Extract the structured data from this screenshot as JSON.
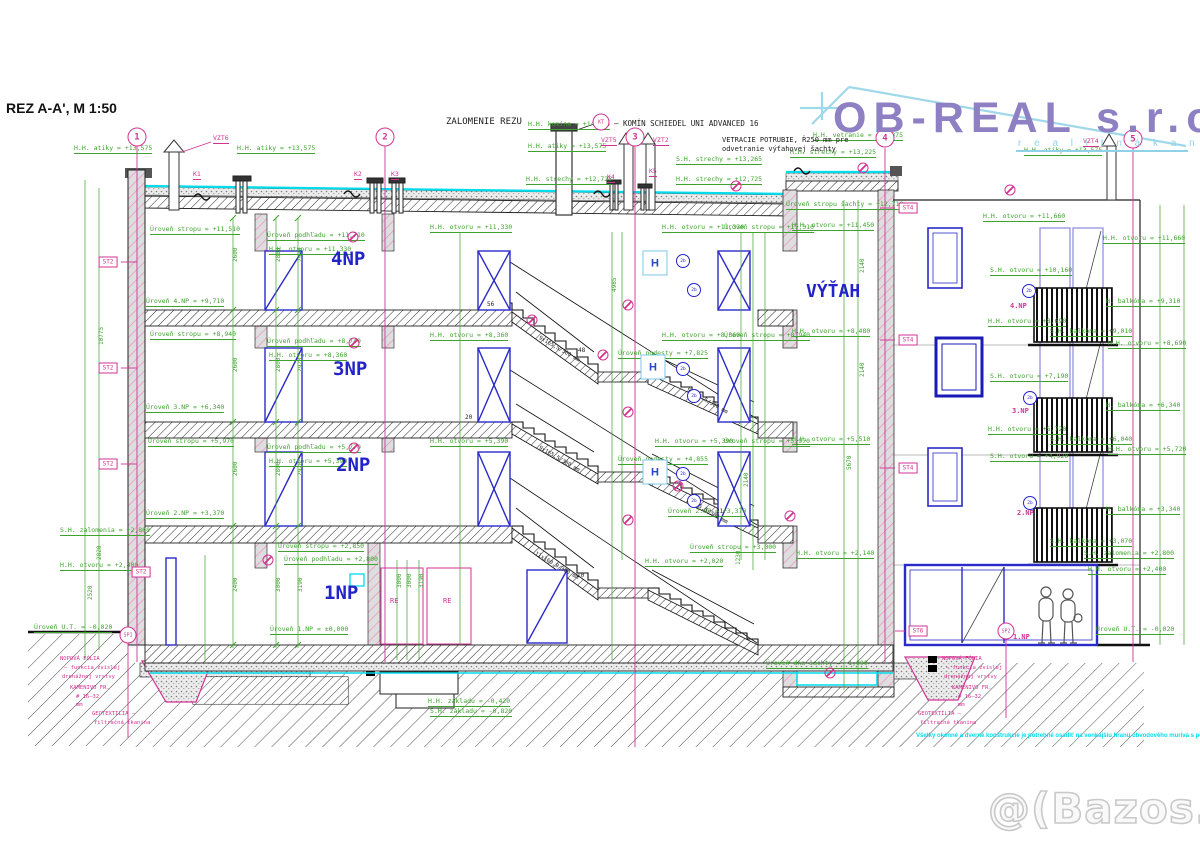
{
  "title": {
    "text": "REZ A-A', M 1:50"
  },
  "logo": {
    "brand": "OB-REAL s.r.o.",
    "tagline": "r e a l i t n á   k a n c e l á r i a"
  },
  "watermark": {
    "text": "@(Bazos.sk"
  },
  "note": {
    "text": "Všetky okenné a dverné konštrukcie je potrebné osadiť na vonkajšiu hranu obvodového muriva s použitím kotiev"
  },
  "h_label": "H",
  "colors": {
    "dim_green": "#3da32c",
    "marker_magenta": "#d23393",
    "element_blue": "#2323cc",
    "waterproof_cyan": "#00dcec",
    "logo_purple": "#8f80c4",
    "logo_lightblue": "#8fd2e8"
  },
  "axis_markers": [
    {
      "n": "1",
      "x": 137,
      "y": 137
    },
    {
      "n": "2",
      "x": 385,
      "y": 137
    },
    {
      "n": "3",
      "x": 635,
      "y": 137
    },
    {
      "n": "4",
      "x": 885,
      "y": 138
    },
    {
      "n": "5",
      "x": 1133,
      "y": 139
    }
  ],
  "boxed_labels": [
    {
      "t": "ST2",
      "x": 108,
      "y": 262
    },
    {
      "t": "ST2",
      "x": 108,
      "y": 368
    },
    {
      "t": "ST2",
      "x": 108,
      "y": 464
    },
    {
      "t": "ST2",
      "x": 141,
      "y": 572
    },
    {
      "t": "ST4",
      "x": 908,
      "y": 208
    },
    {
      "t": "ST4",
      "x": 908,
      "y": 340
    },
    {
      "t": "ST4",
      "x": 908,
      "y": 468
    },
    {
      "t": "ST6",
      "x": 918,
      "y": 631
    }
  ],
  "circle_labels": [
    {
      "t": "KT",
      "x": 601,
      "y": 122
    },
    {
      "t": "SP1",
      "x": 128,
      "y": 635
    },
    {
      "t": "SP2",
      "x": 1006,
      "y": 631
    }
  ],
  "small_circles": [
    {
      "t": "2b",
      "x": 683,
      "y": 261
    },
    {
      "t": "2b",
      "x": 694,
      "y": 290
    },
    {
      "t": "2b",
      "x": 683,
      "y": 369
    },
    {
      "t": "2b",
      "x": 694,
      "y": 396
    },
    {
      "t": "2b",
      "x": 683,
      "y": 474
    },
    {
      "t": "2b",
      "x": 694,
      "y": 501
    },
    {
      "t": "2b",
      "x": 1029,
      "y": 291
    },
    {
      "t": "2b",
      "x": 1030,
      "y": 398
    },
    {
      "t": "2b",
      "x": 1030,
      "y": 503
    }
  ],
  "h_boxes": [
    {
      "x": 655,
      "y": 263
    },
    {
      "x": 653,
      "y": 367
    },
    {
      "x": 655,
      "y": 472
    }
  ],
  "detail_circles": [
    {
      "x": 353,
      "y": 237
    },
    {
      "x": 354,
      "y": 343
    },
    {
      "x": 354,
      "y": 448
    },
    {
      "x": 268,
      "y": 560
    },
    {
      "x": 532,
      "y": 320
    },
    {
      "x": 603,
      "y": 355
    },
    {
      "x": 678,
      "y": 486
    },
    {
      "x": 790,
      "y": 516
    },
    {
      "x": 830,
      "y": 673
    },
    {
      "x": 1010,
      "y": 190
    },
    {
      "x": 628,
      "y": 305
    },
    {
      "x": 628,
      "y": 412
    },
    {
      "x": 628,
      "y": 520
    },
    {
      "x": 736,
      "y": 186
    },
    {
      "x": 863,
      "y": 168
    }
  ],
  "labels": [
    {
      "t": "H.H. atiky = +13,575",
      "x": 74,
      "y": 145
    },
    {
      "t": "H.H. atiky = +13,575",
      "x": 237,
      "y": 145
    },
    {
      "t": "H.H. komína = +14,225",
      "x": 528,
      "y": 121
    },
    {
      "t": "H.H. atiky = +13,575",
      "x": 528,
      "y": 143
    },
    {
      "t": "S.H. strechy = +13,265",
      "x": 676,
      "y": 156
    },
    {
      "t": "H.H. strechy = +12,725",
      "x": 526,
      "y": 176
    },
    {
      "t": "H.H. strechy = +12,725",
      "x": 676,
      "y": 176
    },
    {
      "t": "H.H. atiky = +13,575",
      "x": 1024,
      "y": 147
    },
    {
      "t": "H.H. vetranie = +13,875",
      "x": 813,
      "y": 132
    },
    {
      "t": "H.H. strechy = +13,225",
      "x": 790,
      "y": 149
    },
    {
      "t": "Úroveň stropu šachty = +12,710",
      "x": 786,
      "y": 201
    },
    {
      "t": "H.H. otvoru = +11,450",
      "x": 792,
      "y": 222
    },
    {
      "t": "Úroveň stropu = +11,510",
      "x": 150,
      "y": 226
    },
    {
      "t": "Úroveň podhľadu = +11,710",
      "x": 267,
      "y": 232
    },
    {
      "t": "H.H. otvoru = +11,330",
      "x": 269,
      "y": 246
    },
    {
      "t": "H.H. otvoru = +11,330",
      "x": 430,
      "y": 224
    },
    {
      "t": "H.H. otvoru = +11,330",
      "x": 662,
      "y": 224
    },
    {
      "t": "Úroveň stropu = +11,310",
      "x": 724,
      "y": 224
    },
    {
      "t": "Úroveň 4.NP = +9,710",
      "x": 146,
      "y": 298
    },
    {
      "t": "Úroveň stropu = +8,940",
      "x": 150,
      "y": 331
    },
    {
      "t": "Úroveň podhľadu = +8,740",
      "x": 267,
      "y": 338
    },
    {
      "t": "H.H. otvoru = +8,360",
      "x": 269,
      "y": 352
    },
    {
      "t": "H.H. otvoru = +8,360",
      "x": 430,
      "y": 332
    },
    {
      "t": "H.H. otvoru = +8,360",
      "x": 662,
      "y": 332
    },
    {
      "t": "Úroveň stropu = +8,940",
      "x": 724,
      "y": 332
    },
    {
      "t": "Úroveň podesty = +7,825",
      "x": 618,
      "y": 350
    },
    {
      "t": "Úroveň 3.NP = +6,340",
      "x": 146,
      "y": 404
    },
    {
      "t": "Úroveň stropu = +5,970",
      "x": 148,
      "y": 438
    },
    {
      "t": "Úroveň podhľadu = +5,770",
      "x": 267,
      "y": 444
    },
    {
      "t": "H.H. otvoru = +5,390",
      "x": 269,
      "y": 458
    },
    {
      "t": "H.H. otvoru = +5,390",
      "x": 430,
      "y": 438
    },
    {
      "t": "H.H. otvoru = +5,390",
      "x": 655,
      "y": 438
    },
    {
      "t": "Úroveň stropu = +5,970",
      "x": 724,
      "y": 438
    },
    {
      "t": "Úroveň podesty = +4,855",
      "x": 618,
      "y": 456
    },
    {
      "t": "Úroveň 2.NP = +3,370",
      "x": 146,
      "y": 510
    },
    {
      "t": "Úroveň 2.NP = +3,370",
      "x": 668,
      "y": 508
    },
    {
      "t": "Úroveň stropu = +3,000",
      "x": 690,
      "y": 544
    },
    {
      "t": "Úroveň stropu = +2,850",
      "x": 278,
      "y": 543
    },
    {
      "t": "Úroveň podhľadu = +2,800",
      "x": 284,
      "y": 556
    },
    {
      "t": "S.H. zalomenia = +2,800",
      "x": 60,
      "y": 527
    },
    {
      "t": "H.H. otvoru = +2,400",
      "x": 60,
      "y": 562
    },
    {
      "t": "Úroveň U.T. = -0,020",
      "x": 34,
      "y": 624
    },
    {
      "t": "Úroveň 1.NP = ±0,000",
      "x": 270,
      "y": 626
    },
    {
      "t": "H.H. otvoru = +8,480",
      "x": 792,
      "y": 328
    },
    {
      "t": "H.H. otvoru = +5,510",
      "x": 792,
      "y": 436
    },
    {
      "t": "H.H. otvoru = +2,140",
      "x": 796,
      "y": 550
    },
    {
      "t": "H.H. otvoru = +2,020",
      "x": 645,
      "y": 558
    },
    {
      "t": "Úroveň dna šachty = -1,000",
      "x": 766,
      "y": 660
    },
    {
      "t": "H.H. základu = -0,420",
      "x": 428,
      "y": 698
    },
    {
      "t": "S.H. základu = -0,820",
      "x": 430,
      "y": 708
    },
    {
      "t": "S.H. zalomenia = +2,800",
      "x": 1084,
      "y": 550
    },
    {
      "t": "H.H. otvoru = +2,400",
      "x": 1088,
      "y": 566
    },
    {
      "t": "Úroveň U.T. = -0,020",
      "x": 1096,
      "y": 626
    },
    {
      "t": "H.H. otvoru = +11,660",
      "x": 983,
      "y": 213
    },
    {
      "t": "H.H. otvoru = +11,660",
      "x": 1103,
      "y": 235
    },
    {
      "t": "S.H. otvoru = +10,160",
      "x": 990,
      "y": 267
    },
    {
      "t": "H. balkóna = +9,310",
      "x": 1106,
      "y": 298
    },
    {
      "t": "H.H. otvoru = +8,690",
      "x": 988,
      "y": 318
    },
    {
      "t": "S.H. balkóna = +9,010",
      "x": 1050,
      "y": 328
    },
    {
      "t": "H.H. otvoru = +8,690",
      "x": 1108,
      "y": 340
    },
    {
      "t": "S.H. otvoru = +7,190",
      "x": 990,
      "y": 373
    },
    {
      "t": "H. balkóna = +6,340",
      "x": 1106,
      "y": 402
    },
    {
      "t": "H.H. otvoru = +5,720",
      "x": 988,
      "y": 426
    },
    {
      "t": "S.H. balkóna = +6,040",
      "x": 1050,
      "y": 436
    },
    {
      "t": "H.H. otvoru = +5,720",
      "x": 1108,
      "y": 446
    },
    {
      "t": "S.H. otvoru = +4,920",
      "x": 990,
      "y": 453
    },
    {
      "t": "H. balkóna = +3,340",
      "x": 1106,
      "y": 506
    },
    {
      "t": "S.H. balkóna = +3,070",
      "x": 1050,
      "y": 538
    },
    {
      "t": "10775",
      "x": 99,
      "y": 345,
      "r": -90,
      "s": 6
    },
    {
      "t": "2820",
      "x": 97,
      "y": 560,
      "r": -90,
      "s": 6
    },
    {
      "t": "2520",
      "x": 88,
      "y": 600,
      "r": -90,
      "s": 6
    },
    {
      "t": "2600",
      "x": 233,
      "y": 262,
      "r": -90,
      "s": 6
    },
    {
      "t": "2800",
      "x": 276,
      "y": 262,
      "r": -90,
      "s": 6
    },
    {
      "t": "2920",
      "x": 298,
      "y": 262,
      "r": -90,
      "s": 6
    },
    {
      "t": "2600",
      "x": 233,
      "y": 372,
      "r": -90,
      "s": 6
    },
    {
      "t": "2800",
      "x": 276,
      "y": 372,
      "r": -90,
      "s": 6
    },
    {
      "t": "2920",
      "x": 298,
      "y": 372,
      "r": -90,
      "s": 6
    },
    {
      "t": "2600",
      "x": 233,
      "y": 476,
      "r": -90,
      "s": 6
    },
    {
      "t": "2800",
      "x": 276,
      "y": 476,
      "r": -90,
      "s": 6
    },
    {
      "t": "2920",
      "x": 298,
      "y": 476,
      "r": -90,
      "s": 6
    },
    {
      "t": "2400",
      "x": 233,
      "y": 592,
      "r": -90,
      "s": 6
    },
    {
      "t": "3000",
      "x": 276,
      "y": 592,
      "r": -90,
      "s": 6
    },
    {
      "t": "3190",
      "x": 298,
      "y": 592,
      "r": -90,
      "s": 6
    },
    {
      "t": "4985",
      "x": 612,
      "y": 292,
      "r": -90,
      "s": 6
    },
    {
      "t": "3000",
      "x": 397,
      "y": 588,
      "r": -90,
      "s": 6
    },
    {
      "t": "3000",
      "x": 407,
      "y": 588,
      "r": -90,
      "s": 6
    },
    {
      "t": "3190",
      "x": 419,
      "y": 588,
      "r": -90,
      "s": 6
    },
    {
      "t": "2140",
      "x": 744,
      "y": 487,
      "r": -90,
      "s": 6
    },
    {
      "t": "1230",
      "x": 736,
      "y": 565,
      "r": -90,
      "s": 6
    },
    {
      "t": "5670",
      "x": 847,
      "y": 470,
      "r": -90,
      "s": 6
    },
    {
      "t": "2140",
      "x": 860,
      "y": 273,
      "r": -90,
      "s": 6
    },
    {
      "t": "2140",
      "x": 860,
      "y": 377,
      "r": -90,
      "s": 6
    },
    {
      "t": "VZT6",
      "x": 213,
      "y": 135,
      "c": "m",
      "u": 1
    },
    {
      "t": "VZT5",
      "x": 601,
      "y": 137,
      "c": "m",
      "u": 1
    },
    {
      "t": "VZT2",
      "x": 653,
      "y": 137,
      "c": "m",
      "u": 1
    },
    {
      "t": "VZT4",
      "x": 1083,
      "y": 138,
      "c": "m",
      "u": 1
    },
    {
      "t": "K1",
      "x": 193,
      "y": 171,
      "c": "m",
      "u": 1
    },
    {
      "t": "K2",
      "x": 354,
      "y": 171,
      "c": "m",
      "u": 1
    },
    {
      "t": "K3",
      "x": 391,
      "y": 171,
      "c": "m",
      "u": 1
    },
    {
      "t": "K4",
      "x": 607,
      "y": 174,
      "c": "m",
      "u": 1
    },
    {
      "t": "K5",
      "x": 649,
      "y": 168,
      "c": "m",
      "u": 1
    },
    {
      "t": "RE",
      "x": 390,
      "y": 598,
      "c": "m",
      "s": 7
    },
    {
      "t": "RE",
      "x": 443,
      "y": 598,
      "c": "m",
      "s": 7
    },
    {
      "t": "4.NP",
      "x": 1010,
      "y": 303,
      "c": "m",
      "s": 7,
      "w": 1
    },
    {
      "t": "3.NP",
      "x": 1012,
      "y": 408,
      "c": "m",
      "s": 7,
      "w": 1
    },
    {
      "t": "2.NP",
      "x": 1017,
      "y": 510,
      "c": "m",
      "s": 7,
      "w": 1
    },
    {
      "t": "1.NP",
      "x": 1013,
      "y": 634,
      "c": "m",
      "s": 7,
      "w": 1
    },
    {
      "t": "NOPOVÁ FÓLIA",
      "x": 60,
      "y": 657,
      "c": "m",
      "s": 5.5
    },
    {
      "t": "– funkcia zvislej",
      "x": 64,
      "y": 666,
      "c": "m",
      "s": 5.5
    },
    {
      "t": "drenážnej vrstvy",
      "x": 62,
      "y": 675,
      "c": "m",
      "s": 5.5
    },
    {
      "t": "KAMENIVO FR.",
      "x": 70,
      "y": 686,
      "c": "m",
      "s": 5.5
    },
    {
      "t": "# 16–32",
      "x": 76,
      "y": 695,
      "c": "m",
      "s": 5.5
    },
    {
      "t": "mm",
      "x": 76,
      "y": 703,
      "c": "m",
      "s": 5.5
    },
    {
      "t": "GEOTEXTÍLIA –",
      "x": 92,
      "y": 712,
      "c": "m",
      "s": 5.5
    },
    {
      "t": "filtračná tkanina",
      "x": 94,
      "y": 721,
      "c": "m",
      "s": 5.5
    },
    {
      "t": "NOPOVÁ FÓLIA",
      "x": 942,
      "y": 657,
      "c": "m",
      "s": 5.5
    },
    {
      "t": "– funkcia zvislej",
      "x": 946,
      "y": 666,
      "c": "m",
      "s": 5.5
    },
    {
      "t": "drenážnej vrstvy",
      "x": 944,
      "y": 675,
      "c": "m",
      "s": 5.5
    },
    {
      "t": "KAMENIVO FR.",
      "x": 952,
      "y": 686,
      "c": "m",
      "s": 5.5
    },
    {
      "t": "# 16–32",
      "x": 958,
      "y": 695,
      "c": "m",
      "s": 5.5
    },
    {
      "t": "mm",
      "x": 958,
      "y": 703,
      "c": "m",
      "s": 5.5
    },
    {
      "t": "GEOTEXTÍLIA –",
      "x": 918,
      "y": 712,
      "c": "m",
      "s": 5.5
    },
    {
      "t": "filtračná tkanina",
      "x": 920,
      "y": 721,
      "c": "m",
      "s": 5.5
    },
    {
      "t": "ZALOMENIE REZU",
      "x": 446,
      "y": 118,
      "c": "k",
      "s": 9
    },
    {
      "t": "– KOMÍN SCHIEDEL UNI ADVANCED 16",
      "x": 614,
      "y": 120,
      "c": "k",
      "s": 7.5
    },
    {
      "t": "VETRACIE POTRUBIE, Ř250 mm pre",
      "x": 722,
      "y": 137,
      "c": "k",
      "s": 7
    },
    {
      "t": "odvetranie výťahovej šachty",
      "x": 722,
      "y": 146,
      "c": "k",
      "s": 7
    },
    {
      "t": "56",
      "x": 487,
      "y": 302,
      "c": "k",
      "s": 6
    },
    {
      "t": "48",
      "x": 578,
      "y": 348,
      "c": "k",
      "s": 6
    },
    {
      "t": "20",
      "x": 465,
      "y": 415,
      "c": "k",
      "s": 6
    },
    {
      "t": "21",
      "x": 716,
      "y": 509,
      "c": "k",
      "s": 6
    },
    {
      "t": "10",
      "x": 577,
      "y": 573,
      "c": "k",
      "s": 6
    },
    {
      "t": "9x165,5/300 mm",
      "x": 540,
      "y": 336,
      "c": "k",
      "s": 5.5,
      "r": 30
    },
    {
      "t": "9x165,5/300 mm",
      "x": 688,
      "y": 388,
      "c": "k",
      "s": 5.5,
      "r": 30
    },
    {
      "t": "9x165,5/300 mm",
      "x": 540,
      "y": 446,
      "c": "k",
      "s": 5.5,
      "r": 30
    },
    {
      "t": "9x165,5/300 mm",
      "x": 688,
      "y": 498,
      "c": "k",
      "s": 5.5,
      "r": 30
    },
    {
      "t": "11x160,9/300 mm",
      "x": 536,
      "y": 552,
      "c": "k",
      "s": 5.5,
      "r": 30
    },
    {
      "t": "4NP",
      "x": 331,
      "y": 250,
      "c": "b",
      "s": 19
    },
    {
      "t": "3NP",
      "x": 333,
      "y": 360,
      "c": "b",
      "s": 19
    },
    {
      "t": "2NP",
      "x": 336,
      "y": 456,
      "c": "b",
      "s": 19
    },
    {
      "t": "1NP",
      "x": 324,
      "y": 584,
      "c": "b",
      "s": 19
    },
    {
      "t": "VÝŤAH",
      "x": 806,
      "y": 283,
      "c": "b",
      "s": 18
    }
  ]
}
